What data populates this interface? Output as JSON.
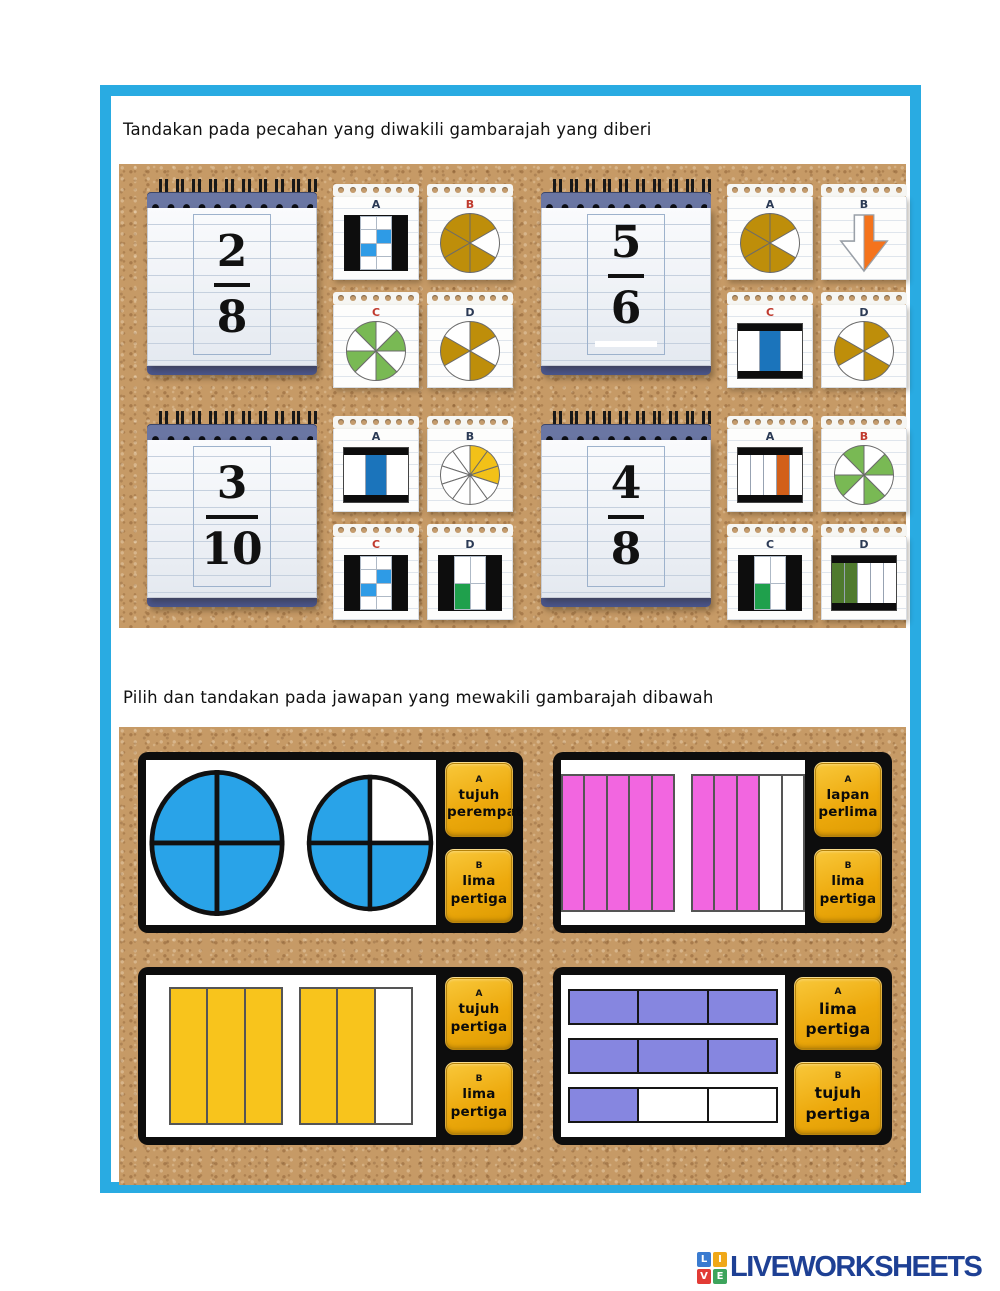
{
  "titles": {
    "section1": "Tandakan pada pecahan yang diwakili gambarajah yang diberi",
    "section2": "Pilih dan tandakan pada jawapan yang mewakili gambarajah dibawah"
  },
  "colors": {
    "frame": "#29ABE2",
    "cork": "#C69A66",
    "gold_button": "#EDA90C",
    "brand_text": "#1E4094"
  },
  "section1": {
    "questions": [
      {
        "numerator": "2",
        "denominator": "8",
        "underline": false,
        "options": [
          {
            "letter": "A",
            "letter_color": "#2b3a55",
            "diagram": {
              "kind": "grid",
              "rows": 4,
              "cols": 2,
              "filled": [
                3,
                4
              ],
              "fill": "#2E9BE6"
            }
          },
          {
            "letter": "B",
            "letter_color": "#c03a2e",
            "diagram": {
              "kind": "pie",
              "slices": 6,
              "start": -30,
              "filled": [
                1,
                2,
                3,
                4,
                5
              ],
              "fill": "#BE8E0A"
            }
          },
          {
            "letter": "C",
            "letter_color": "#c03a2e",
            "diagram": {
              "kind": "pie",
              "slices": 8,
              "start": 0,
              "filled": [
                0,
                2,
                4,
                6
              ],
              "fill": "#79B954"
            }
          },
          {
            "letter": "D",
            "letter_color": "#2b3a55",
            "diagram": {
              "kind": "pie",
              "slices": 6,
              "start": -30,
              "filled": [
                1,
                3,
                5
              ],
              "fill": "#BE8E0A"
            }
          }
        ]
      },
      {
        "numerator": "5",
        "denominator": "6",
        "underline": true,
        "options": [
          {
            "letter": "A",
            "letter_color": "#2b3a55",
            "diagram": {
              "kind": "pie",
              "slices": 6,
              "start": -30,
              "filled": [
                1,
                2,
                3,
                4,
                5
              ],
              "fill": "#BE8E0A"
            }
          },
          {
            "letter": "B",
            "letter_color": "#2b3a55",
            "diagram": {
              "kind": "arrow",
              "fill": "#F4731C"
            }
          },
          {
            "letter": "C",
            "letter_color": "#c03a2e",
            "diagram": {
              "kind": "bars",
              "parts": 3,
              "filled": [
                1
              ],
              "fill": "#1B74BB"
            }
          },
          {
            "letter": "D",
            "letter_color": "#2b3a55",
            "diagram": {
              "kind": "pie",
              "slices": 6,
              "start": -30,
              "filled": [
                1,
                3,
                5
              ],
              "fill": "#BE8E0A"
            }
          }
        ]
      },
      {
        "numerator": "3",
        "denominator": "10",
        "underline": false,
        "options": [
          {
            "letter": "A",
            "letter_color": "#2b3a55",
            "diagram": {
              "kind": "bars",
              "parts": 3,
              "filled": [
                1
              ],
              "fill": "#1B74BB"
            }
          },
          {
            "letter": "B",
            "letter_color": "#2b3a55",
            "diagram": {
              "kind": "pie",
              "slices": 10,
              "start": -18,
              "filled": [
                0,
                1,
                2
              ],
              "fill": "#F2C118"
            }
          },
          {
            "letter": "C",
            "letter_color": "#c03a2e",
            "diagram": {
              "kind": "grid",
              "rows": 4,
              "cols": 2,
              "filled": [
                3,
                4
              ],
              "fill": "#2E9BE6"
            }
          },
          {
            "letter": "D",
            "letter_color": "#2b3a55",
            "diagram": {
              "kind": "grid",
              "rows": 2,
              "cols": 2,
              "filled": [
                2
              ],
              "fill": "#1FA04C"
            }
          }
        ]
      },
      {
        "numerator": "4",
        "denominator": "8",
        "underline": false,
        "options": [
          {
            "letter": "A",
            "letter_color": "#2b3a55",
            "diagram": {
              "kind": "bars",
              "parts": 5,
              "filled": [
                3
              ],
              "fill": "#D2601A"
            }
          },
          {
            "letter": "B",
            "letter_color": "#c03a2e",
            "diagram": {
              "kind": "pie",
              "slices": 8,
              "start": 0,
              "filled": [
                0,
                2,
                4,
                6
              ],
              "fill": "#79B954"
            }
          },
          {
            "letter": "C",
            "letter_color": "#2b3a55",
            "diagram": {
              "kind": "grid",
              "rows": 2,
              "cols": 2,
              "filled": [
                2
              ],
              "fill": "#1FA04C"
            }
          },
          {
            "letter": "D",
            "letter_color": "#2b3a55",
            "diagram": {
              "kind": "bars",
              "parts": 5,
              "filled": [
                0,
                1
              ],
              "fill": "#4F7A2E"
            }
          }
        ]
      }
    ]
  },
  "section2": {
    "panels": [
      {
        "diagram": {
          "kind": "circles",
          "fill": "#29A3E8",
          "groups": [
            {
              "total": 4,
              "filled": [
                0,
                1,
                2,
                3
              ]
            },
            {
              "total": 4,
              "filled": [
                0,
                2,
                3
              ]
            }
          ]
        },
        "answers": [
          {
            "letter": "A",
            "lines": [
              "tujuh",
              "perempat"
            ]
          },
          {
            "letter": "B",
            "lines": [
              "lima",
              "pertiga"
            ]
          }
        ]
      },
      {
        "diagram": {
          "kind": "vstrips",
          "parts": 5,
          "fill": "#F266E0",
          "groups": [
            [
              0,
              1,
              2,
              3,
              4
            ],
            [
              0,
              1,
              2
            ]
          ]
        },
        "answers": [
          {
            "letter": "A",
            "lines": [
              "lapan",
              "perlima"
            ]
          },
          {
            "letter": "B",
            "lines": [
              "lima",
              "pertiga"
            ]
          }
        ]
      },
      {
        "diagram": {
          "kind": "vstrips",
          "parts": 3,
          "fill": "#F8C41C",
          "groups": [
            [
              0,
              1,
              2
            ],
            [
              0,
              1
            ]
          ]
        },
        "answers": [
          {
            "letter": "A",
            "lines": [
              "tujuh",
              "pertiga"
            ]
          },
          {
            "letter": "B",
            "lines": [
              "lima",
              "pertiga"
            ]
          }
        ]
      },
      {
        "diagram": {
          "kind": "hbars",
          "parts": 3,
          "fill": "#8686E0",
          "rows": [
            [
              0,
              1,
              2
            ],
            [
              0,
              1,
              2
            ],
            [
              0
            ]
          ]
        },
        "answers": [
          {
            "letter": "A",
            "lines": [
              "lima",
              "pertiga"
            ]
          },
          {
            "letter": "B",
            "lines": [
              "tujuh",
              "pertiga"
            ]
          }
        ]
      }
    ]
  },
  "footer": {
    "brand": "LIVEWORKSHEETS",
    "tiles": [
      {
        "letter": "L",
        "color": "#3A7BD0"
      },
      {
        "letter": "I",
        "color": "#F0A818"
      },
      {
        "letter": "V",
        "color": "#E23B35"
      },
      {
        "letter": "E",
        "color": "#3DA45C"
      }
    ]
  }
}
